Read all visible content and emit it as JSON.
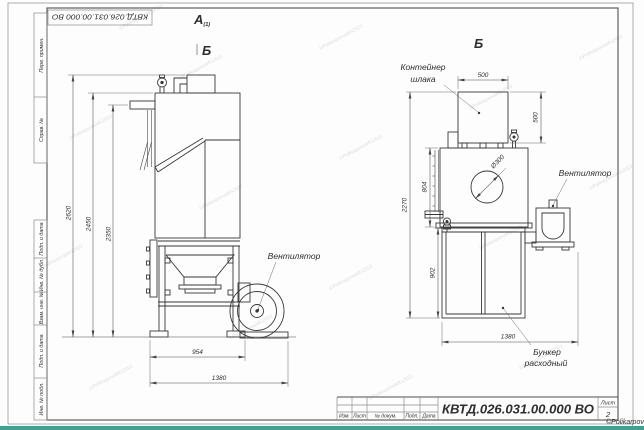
{
  "sheet": {
    "doc_number": "КВТД.026.031.00.000  ВО",
    "doc_number_top": "КВТД.026.031.00.000 ВО",
    "sheet_word": "Лист",
    "sheet_number": "2",
    "watermark": "©PolikarpovaMG2021",
    "watermark_tile": "©PolikarpovaMG2021",
    "stamp_labels": {
      "izm": "Изм.",
      "list": "Лист",
      "doc": "№ докум.",
      "podp": "Подп.",
      "data": "Дата"
    },
    "side_labels_top": {
      "perv": "Перв. примен.",
      "sprav": "Справ. №"
    },
    "side_labels_bottom": {
      "pd1": "Подп. и дата",
      "inv_dubl": "Инв. № дубл.",
      "vzam": "Взам. инв. №",
      "pd2": "Подп. и дата",
      "inv_podl": "Инв. № подл."
    }
  },
  "front_view": {
    "label_a": "А",
    "label_a_sub": "(1)",
    "label_b": "Б",
    "dim_2620": "2620",
    "dim_2450": "2450",
    "dim_2350": "2350",
    "dim_954": "954",
    "dim_1380": "1380",
    "fan_label": "Вентилятор"
  },
  "side_view": {
    "label_b": "Б",
    "container_label_1": "Контейнер",
    "container_label_2": "шлака",
    "fan_label": "Вентилятор",
    "hopper_label_1": "Бункер",
    "hopper_label_2": "расходный",
    "dim_500w": "500",
    "dim_500h": "500",
    "dim_2270": "2270",
    "dim_804": "804",
    "dim_902": "902",
    "dim_1380": "1380",
    "dim_d300": "Ø300"
  },
  "colors": {
    "accent": "#3ba294",
    "line": "#3a3a3a"
  }
}
